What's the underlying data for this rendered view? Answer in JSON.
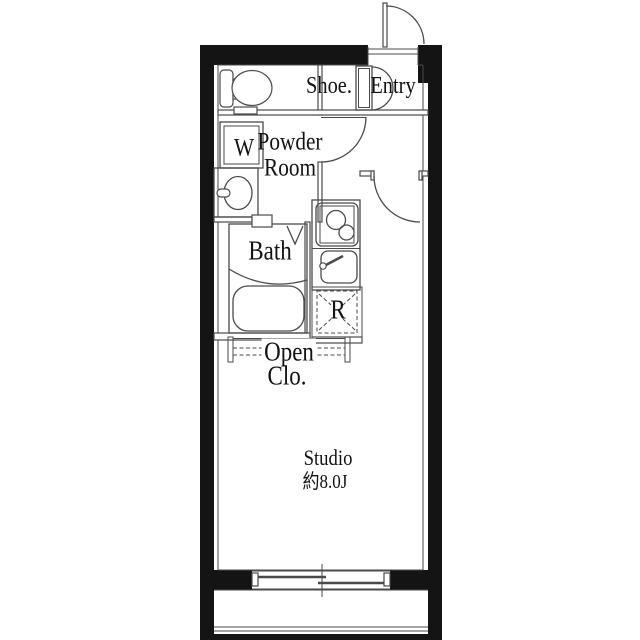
{
  "plan": {
    "rooms": {
      "entry": {
        "shoe_label": "Shoe.",
        "entry_label": "Entry"
      },
      "powder_room": {
        "washer_label": "W",
        "label_line1": "Powder",
        "label_line2": "Room"
      },
      "bath": {
        "label": "Bath"
      },
      "kitchen": {
        "fridge_label": "R"
      },
      "closet": {
        "label_line1": "Open",
        "label_line2": "Clo."
      },
      "studio": {
        "label_line1": "Studio",
        "label_line2": "約8.0J"
      }
    },
    "colors": {
      "wall": "#141414",
      "line": "#4a4a4a",
      "background": "#ffffff"
    }
  }
}
